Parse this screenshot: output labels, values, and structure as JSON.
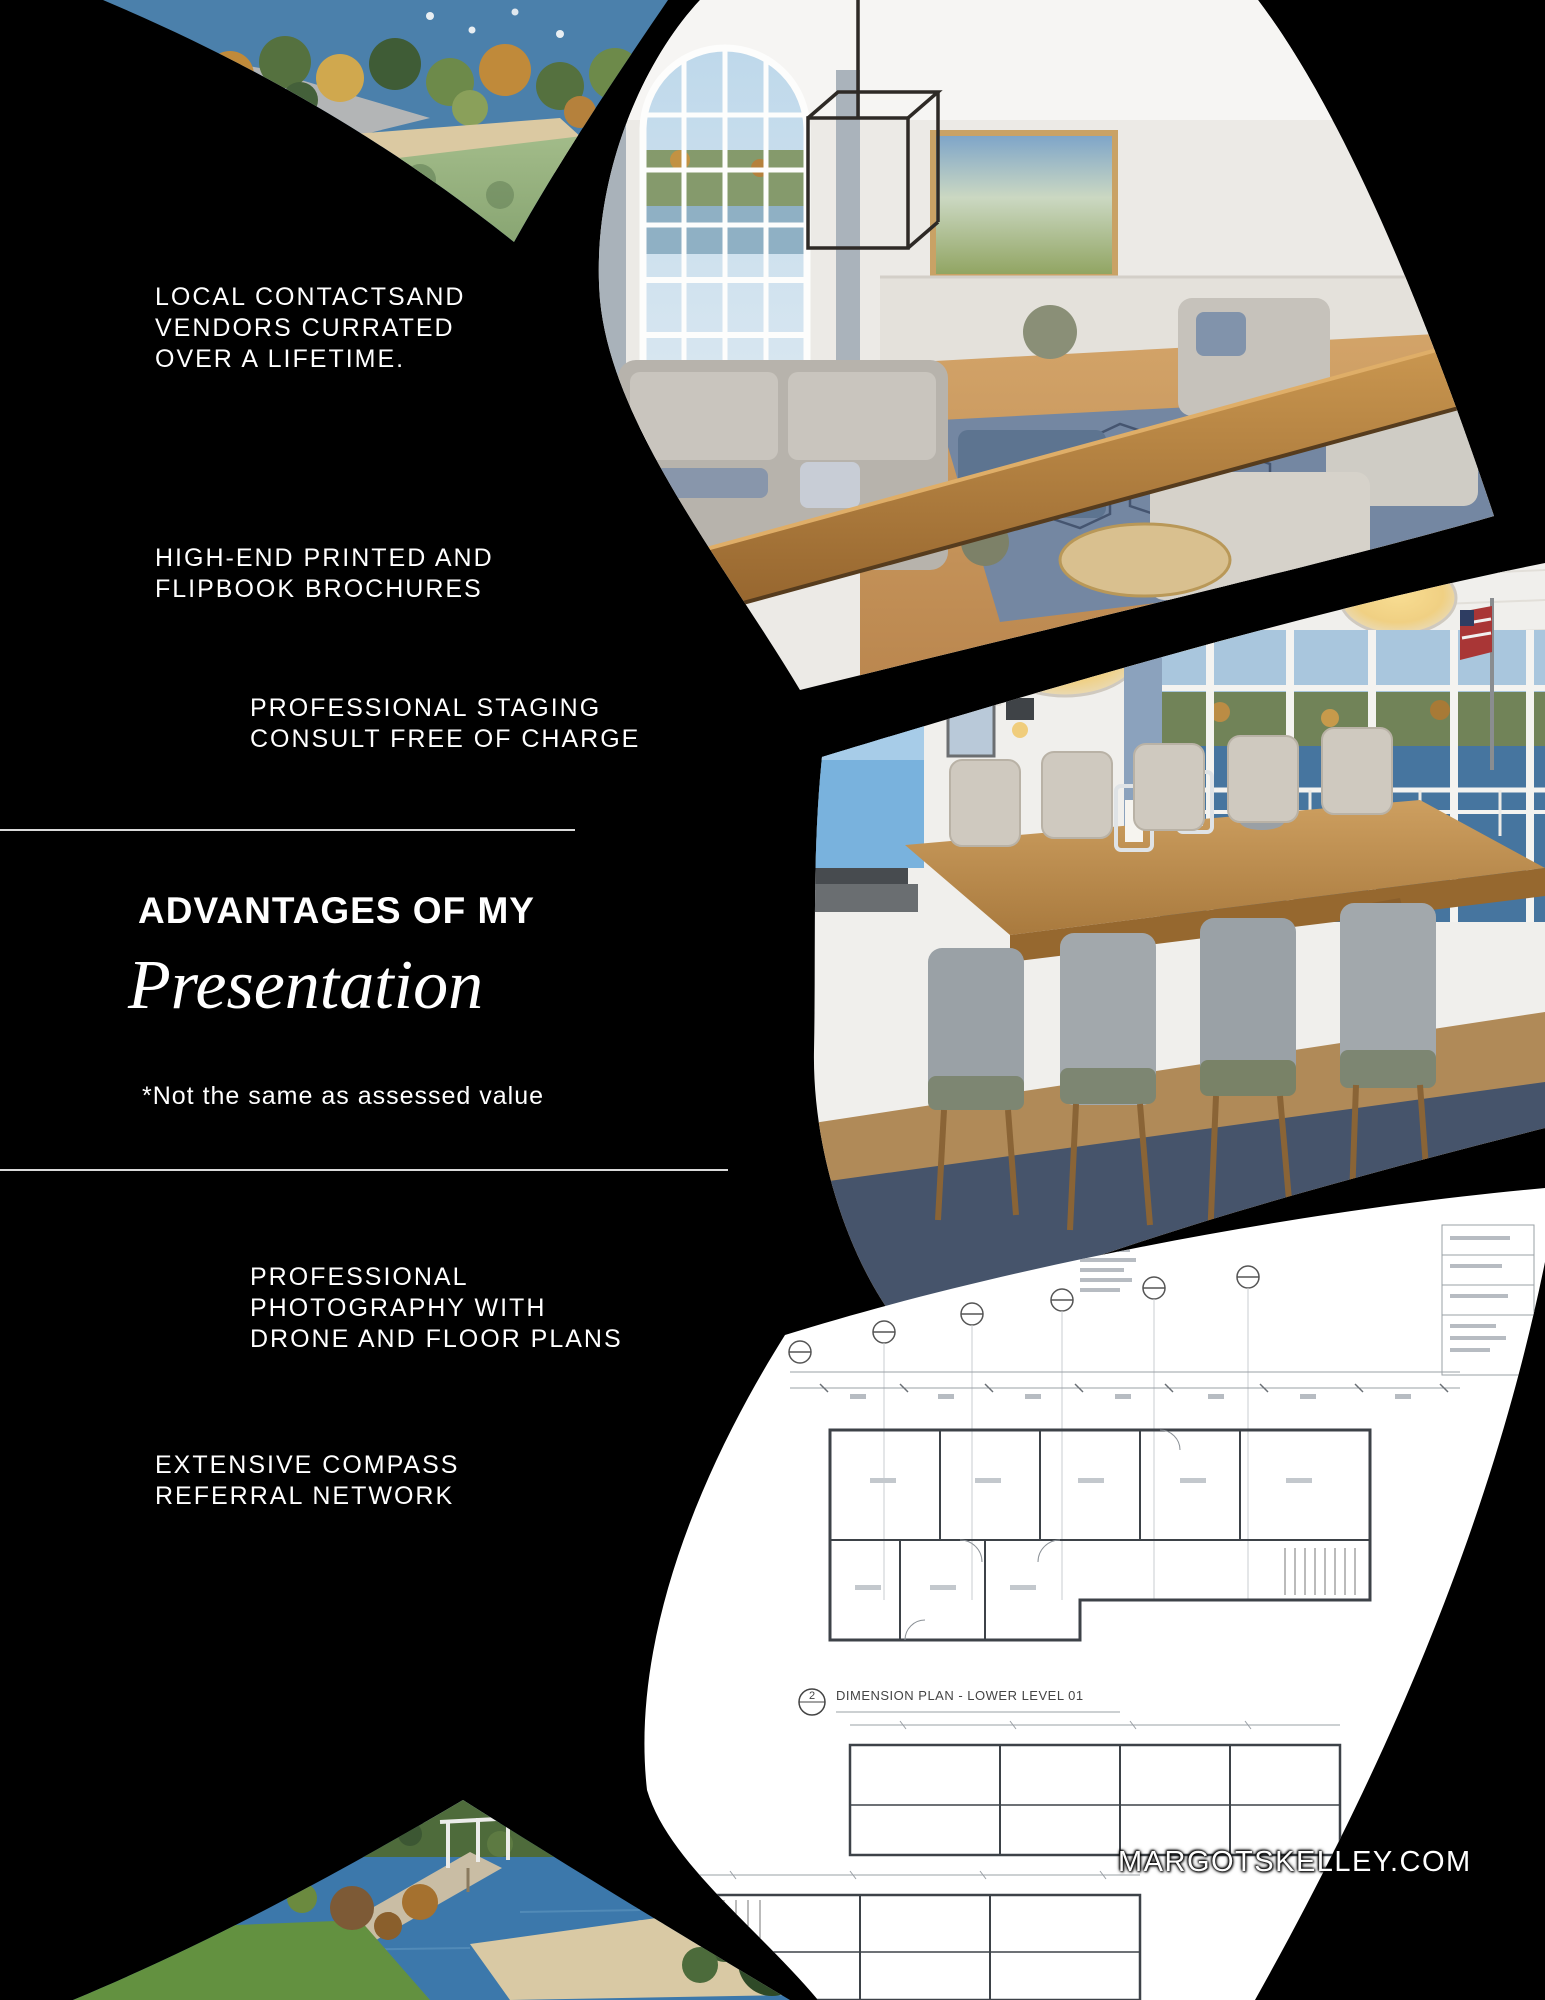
{
  "page": {
    "background": "#000000",
    "website": "MARGOTSKELLEY.COM"
  },
  "benefits": {
    "local_contacts": {
      "lines": [
        "LOCAL CONTACTSAND",
        "VENDORS CURRATED",
        "OVER A LIFETIME."
      ]
    },
    "brochures": {
      "lines": [
        "HIGH-END PRINTED AND",
        "FLIPBOOK BROCHURES"
      ]
    },
    "staging": {
      "lines": [
        "PROFESSIONAL STAGING",
        "CONSULT FREE OF CHARGE"
      ]
    },
    "photography": {
      "lines": [
        "PROFESSIONAL",
        "PHOTOGRAPHY WITH",
        "DRONE AND FLOOR PLANS"
      ]
    },
    "referral": {
      "lines": [
        "EXTENSIVE COMPASS",
        "REFERRAL NETWORK"
      ]
    }
  },
  "heading": {
    "kicker": "ADVANTAGES OF MY",
    "title": "Presentation",
    "footnote": "*Not the same as assessed value"
  },
  "floorplan": {
    "sheet_no": "2",
    "caption": "DIMENSION PLAN - LOWER LEVEL 01"
  },
  "photos": {
    "top_left": "aerial-lake-beach",
    "top_right": "living-room-arched-window",
    "middle_right": "dining-room-lake-view",
    "bottom_right": "architectural-floor-plan",
    "bottom_left": "lake-dock"
  },
  "colors": {
    "background": "#000000",
    "text": "#ffffff",
    "divider": "#d9d9d9"
  }
}
